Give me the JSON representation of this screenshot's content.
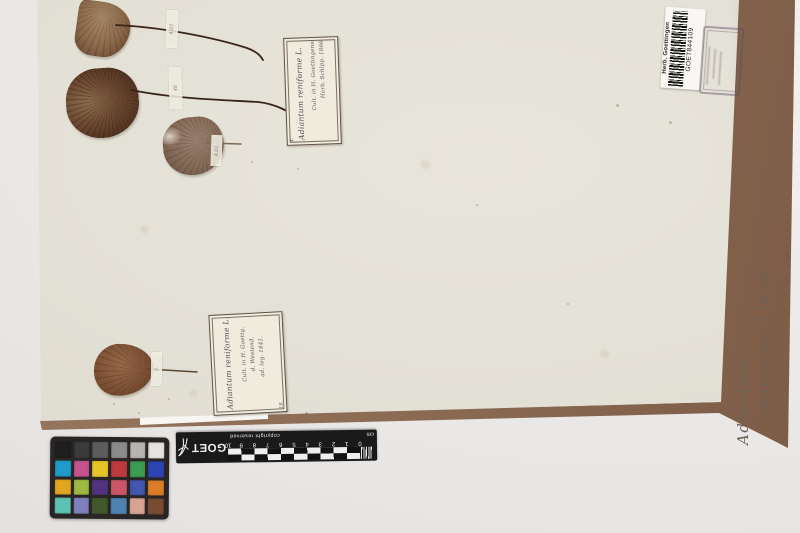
{
  "barcode_label": {
    "herbarium": "Herb. Goettingen",
    "code": "GOET844109"
  },
  "folder": {
    "annotation_line1": "Adiantum",
    "annotation_line2": "reniforme Linné"
  },
  "label_top": {
    "corner_mark": "4.",
    "taxon": "Adiantum reniforme L.",
    "line2": "Cult. in H. Goettingensi",
    "line3": "Herb. Schlpp. 1866"
  },
  "label_bottom": {
    "corner_mark": "18.",
    "taxon": "Adiantum reniforme L.",
    "line2": "Cult. in H. Goettg.",
    "line3": "d. Westend.",
    "line4": "ad. leg. 1841."
  },
  "tape_marks": {
    "t1": "4.01",
    "t2": "46",
    "t3": "4.01",
    "t4": "3."
  },
  "ruler": {
    "brand": "GOET",
    "unit": "cm",
    "copyright": "copyright reserved",
    "ticks": [
      "0",
      "1",
      "2",
      "3",
      "4",
      "5",
      "6",
      "7",
      "8",
      "9",
      "10"
    ]
  },
  "color_checker": {
    "rows": [
      [
        "#1f1e1e",
        "#3c3b3b",
        "#5d5d5e",
        "#8b8b8c",
        "#b6b5b3",
        "#e6e4df"
      ],
      [
        "#1f9bca",
        "#c4538f",
        "#e5c428",
        "#bd3a3f",
        "#3b9c52",
        "#2c44b4"
      ],
      [
        "#e2a51f",
        "#9eba42",
        "#50337f",
        "#cc5668",
        "#4157b0",
        "#dc7d28"
      ],
      [
        "#5cc3b2",
        "#8180be",
        "#42572e",
        "#4e82b0",
        "#d8a392",
        "#7a4b33"
      ]
    ]
  },
  "palette": {
    "sheet": "#e3e0d5",
    "board": "#8b6a53",
    "background": "#ebe9e7",
    "ruler_black": "#1a1a1a",
    "label_paper": "#efebdd"
  }
}
